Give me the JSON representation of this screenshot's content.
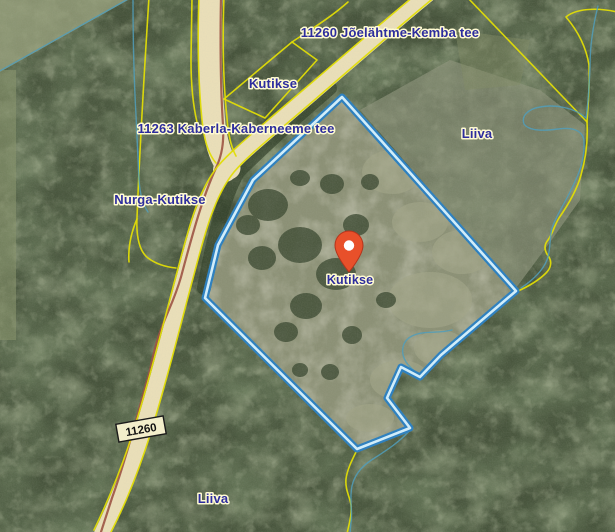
{
  "map": {
    "type": "cadastral-aerial-map",
    "labels": {
      "road_main": "11260 Jõelähtme-Kemba tee",
      "road_cross": "11263 Kaberla-Kaberneeme tee",
      "road_number_badge": "11260",
      "place_kutikse_north": "Kutikse",
      "place_nurga_kutikse": "Nurga-Kutikse",
      "place_liiva_east": "Liiva",
      "place_liiva_south": "Liiva",
      "marker_place": "Kutikse"
    },
    "marker": {
      "name": "Kutikse",
      "color": "#e8502a",
      "x": 349,
      "y": 271
    },
    "selected_parcel": {
      "name": "Kutikse",
      "outline_points": "342,97 253,180 218,245 205,298 357,449 410,428 387,398 401,367 420,377 441,355 516,291",
      "outline_color_outer": "#2a7fc0",
      "outline_color_inner": "#d2effc"
    },
    "colors": {
      "cadastral_line": "#e3de00",
      "road_fill": "#eadfb8",
      "label_text": "#2d2d9e",
      "label_halo": "#fffbd2",
      "stream": "#4e9cba",
      "track": "#9c5140",
      "forest_base": "#45523a"
    }
  }
}
